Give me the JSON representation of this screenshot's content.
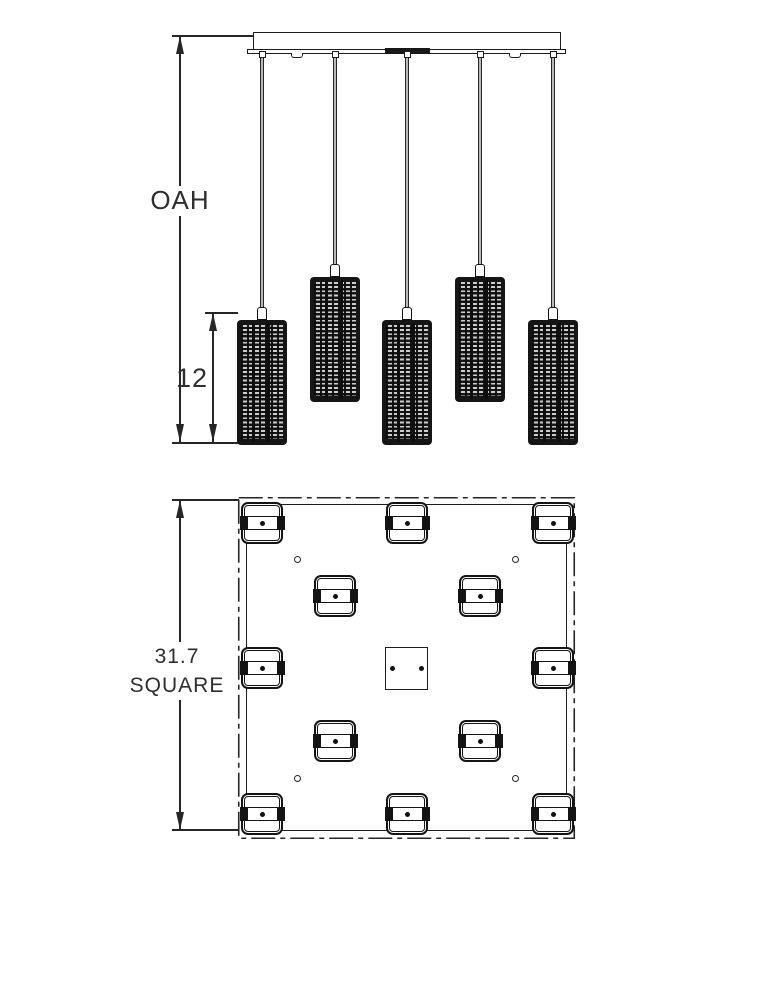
{
  "labels": {
    "overall_height": "OAH",
    "shade_height": "12",
    "plan_size_value": "31.7",
    "plan_size_unit": "SQUARE"
  },
  "counts": {
    "elevation_pendants_visible": 5,
    "plan_pendant_positions": 12
  },
  "colors": {
    "background": "#ffffff",
    "line": "#262626",
    "shade_body": "#151515",
    "shade_stripe": "#cdcdcd"
  }
}
